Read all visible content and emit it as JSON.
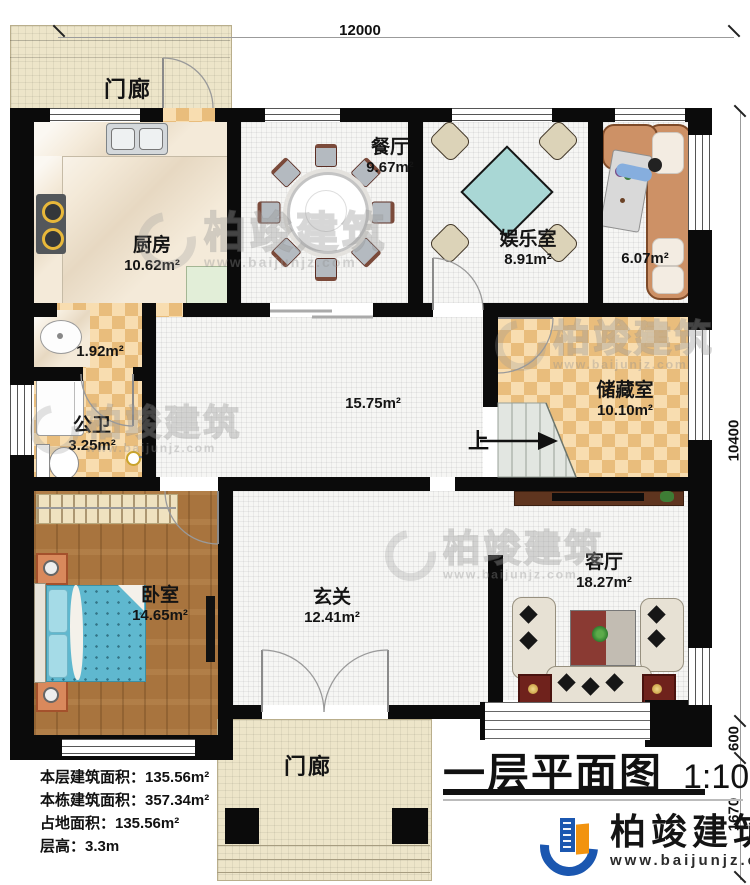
{
  "title_block": {
    "title": "一层平面图",
    "scale": "1:100"
  },
  "dimensions": {
    "top_width": "12000",
    "right_height": "10400",
    "right_step": "600",
    "right_porch": "1670"
  },
  "rooms": {
    "porch_top": {
      "name": "门廊"
    },
    "kitchen": {
      "name": "厨房",
      "area": "10.62m²"
    },
    "dining": {
      "name": "餐厅",
      "area": "9.67m²"
    },
    "entertainment": {
      "name": "娱乐室",
      "area": "8.91m²"
    },
    "lounge": {
      "area": "6.07m²"
    },
    "wash": {
      "area": "1.92m²"
    },
    "bathroom": {
      "name": "公卫",
      "area": "3.25m²"
    },
    "hall": {
      "area": "15.75m²"
    },
    "storage": {
      "name": "储藏室",
      "area": "10.10m²"
    },
    "bedroom": {
      "name": "卧室",
      "area": "14.65m²"
    },
    "foyer": {
      "name": "玄关",
      "area": "12.41m²"
    },
    "living": {
      "name": "客厅",
      "area": "18.27m²"
    },
    "porch_bottom": {
      "name": "门廊"
    }
  },
  "stairs": {
    "up_label": "上"
  },
  "info_block": {
    "line1": "本层建筑面积：135.56m²",
    "line2": "本栋建筑面积：357.34m²",
    "line3": "占地面积：135.56m²",
    "line4": "层高：3.3m"
  },
  "branding": {
    "company": "柏竣建筑",
    "website": "www.baijunjz.com"
  },
  "watermark": {
    "company": "柏竣建筑",
    "website": "www.baijunjz.com"
  },
  "colors": {
    "wall": "#0b0b0b",
    "checker_dark": "#e9bd7c",
    "checker_light": "#f8ddb0",
    "porch": "#ede5c9",
    "wood_floor": "#a8743e",
    "bed": "#6cc0d4",
    "logo_blue": "#1b57b0",
    "logo_orange": "#f2930f"
  }
}
